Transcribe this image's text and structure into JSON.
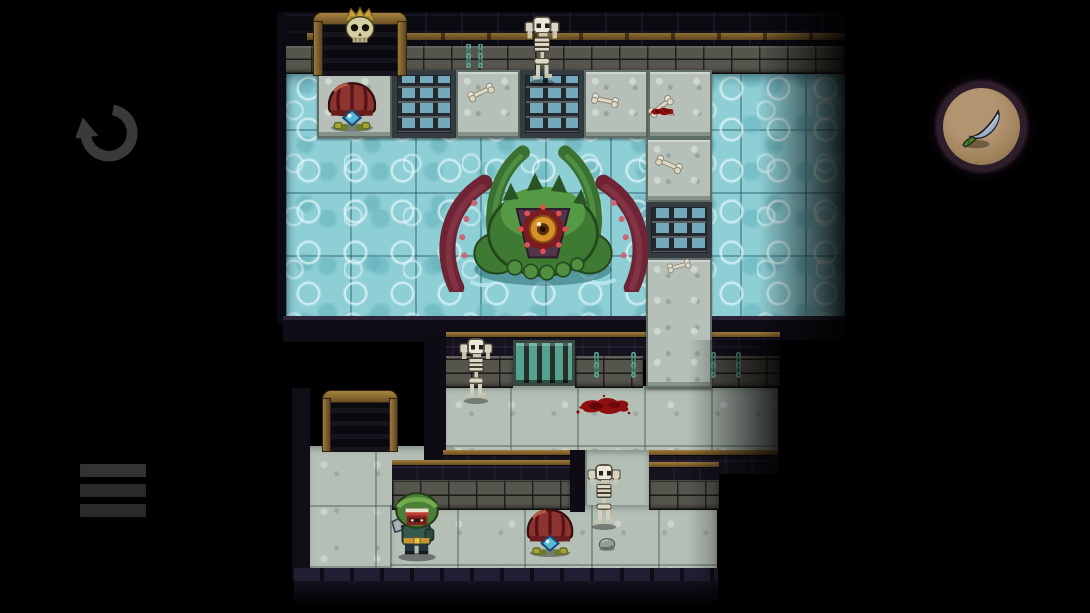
{
  "app": {
    "type": "game",
    "genre": "pixel-art dungeon roguelike",
    "visible_text": "none"
  },
  "hud": {
    "undo_button": {
      "icon": "undo-arrow-icon",
      "color": "#3a3a3a"
    },
    "menu_button": {
      "icon": "hamburger-menu-icon",
      "color": "#2d2d2d"
    },
    "item_slot": {
      "icon": "knife-icon",
      "item": "knife",
      "bg_color": "#a2865e",
      "ring_color": "#2e1e2c"
    }
  },
  "palette": {
    "background": "#000000",
    "water": "#8ecfd5",
    "water_caustic": "#e9fafc",
    "floor_tile": "#b6c0b8",
    "stone_brick": "#55544d",
    "dark_wall": "#16121e",
    "bronze_trim": "#8f6f33",
    "blood": "#8e0f10",
    "boss_green": "#3f7a33",
    "tentacle_red": "#6e2434",
    "mushroom_cap": "#8c3430",
    "hero_hood": "#4c7f37",
    "bone": "#ddd8c6"
  },
  "scene": {
    "rooms": [
      "flooded boss hall",
      "guard room",
      "lower corridor"
    ],
    "entities": [
      {
        "type": "skeleton",
        "name": "skeleton-top",
        "x": 524,
        "y": 16,
        "w": 36,
        "h": 70
      },
      {
        "type": "mushroom",
        "name": "mushroom-top",
        "x": 323,
        "y": 80,
        "w": 58,
        "h": 52
      },
      {
        "type": "bone",
        "x": 466,
        "y": 86,
        "w": 30,
        "h": 13,
        "rot": -25
      },
      {
        "type": "bone",
        "x": 590,
        "y": 94,
        "w": 30,
        "h": 13,
        "rot": 12
      },
      {
        "type": "bone",
        "x": 646,
        "y": 100,
        "w": 30,
        "h": 13,
        "rot": -38
      },
      {
        "type": "blood",
        "name": "blood-small",
        "x": 648,
        "y": 104,
        "w": 28,
        "h": 14
      },
      {
        "type": "bone",
        "x": 654,
        "y": 158,
        "w": 30,
        "h": 13,
        "rot": 24
      },
      {
        "type": "bone",
        "x": 666,
        "y": 260,
        "w": 26,
        "h": 12,
        "rot": -15
      },
      {
        "type": "kraken",
        "name": "boss-kraken",
        "x": 430,
        "y": 128,
        "w": 228,
        "h": 164
      },
      {
        "type": "chain",
        "x": 464,
        "y": 44,
        "w": 9,
        "h": 24
      },
      {
        "type": "chain",
        "x": 476,
        "y": 44,
        "w": 9,
        "h": 24
      },
      {
        "type": "chain",
        "x": 592,
        "y": 352,
        "w": 9,
        "h": 26
      },
      {
        "type": "chain",
        "x": 629,
        "y": 352,
        "w": 9,
        "h": 26
      },
      {
        "type": "chain",
        "x": 709,
        "y": 352,
        "w": 9,
        "h": 26
      },
      {
        "type": "chain",
        "x": 734,
        "y": 352,
        "w": 9,
        "h": 26
      },
      {
        "type": "skeleton",
        "name": "skeleton-middle",
        "x": 458,
        "y": 338,
        "w": 36,
        "h": 66
      },
      {
        "type": "blood",
        "name": "blood-large",
        "x": 574,
        "y": 392,
        "w": 60,
        "h": 26
      },
      {
        "type": "skeleton",
        "name": "skeleton-bottom",
        "x": 586,
        "y": 464,
        "w": 36,
        "h": 66
      },
      {
        "type": "player",
        "name": "hero",
        "x": 390,
        "y": 490,
        "w": 54,
        "h": 72
      },
      {
        "type": "mushroom",
        "name": "mushroom-bottom",
        "x": 522,
        "y": 506,
        "w": 56,
        "h": 52
      },
      {
        "type": "rock",
        "x": 596,
        "y": 536,
        "w": 22,
        "h": 15
      }
    ]
  }
}
